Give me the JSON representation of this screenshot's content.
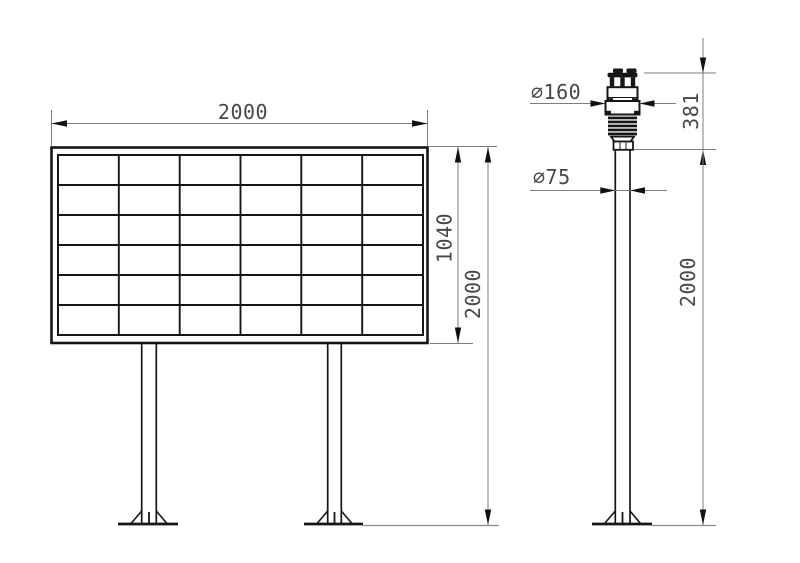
{
  "drawing": {
    "type": "technical-installation-drawing",
    "views": [
      "display-board-front-view",
      "sensor-pole-side-view"
    ],
    "labels": {
      "panel_width": "2000",
      "panel_height": "1040",
      "panel_overall_height": "2000",
      "sensor_diameter": "∅160",
      "sensor_height": "381",
      "pole_diameter": "∅75",
      "pole_overall_height": "2000"
    },
    "panel_grid": {
      "rows": 6,
      "columns": 6
    },
    "colors": {
      "bg": "#ffffff",
      "line": "#161616",
      "dim": "#7c7c7c",
      "arrow": "#111111",
      "text": "#474747"
    }
  }
}
